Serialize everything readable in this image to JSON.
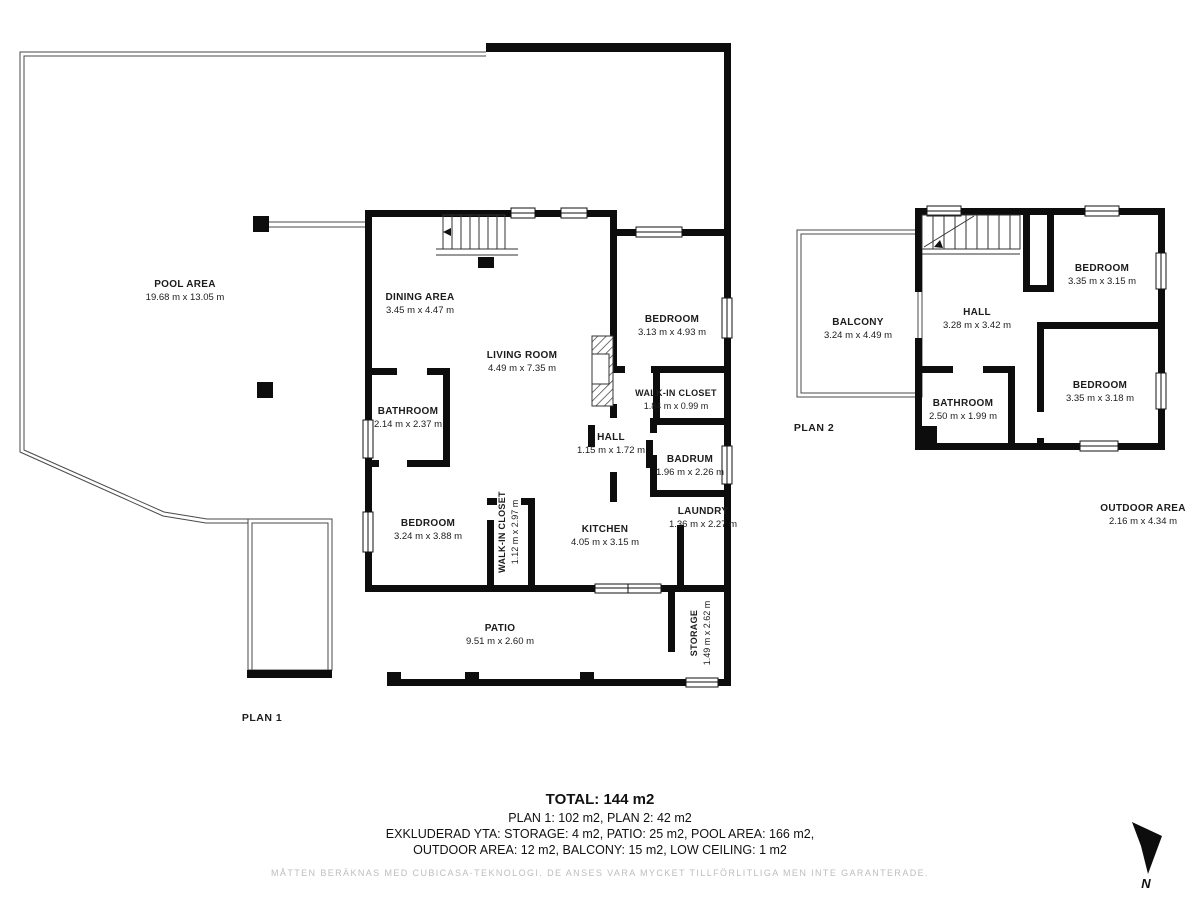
{
  "plan1": {
    "label": "PLAN 1",
    "rooms": {
      "pool": {
        "name": "POOL AREA",
        "dims": "19.68 m x 13.05 m"
      },
      "dining": {
        "name": "DINING AREA",
        "dims": "3.45 m x 4.47 m"
      },
      "living": {
        "name": "LIVING ROOM",
        "dims": "4.49 m x 7.35 m"
      },
      "bedroom_r": {
        "name": "BEDROOM",
        "dims": "3.13 m x 4.93 m"
      },
      "walkin_r": {
        "name": "WALK-IN CLOSET",
        "dims": "1.84 m x 0.99 m"
      },
      "bathroom": {
        "name": "BATHROOM",
        "dims": "2.14 m x 2.37 m"
      },
      "hall": {
        "name": "HALL",
        "dims": "1.15 m x 1.72 m"
      },
      "badrum": {
        "name": "BADRUM",
        "dims": "1.96 m x 2.26 m"
      },
      "laundry": {
        "name": "LAUNDRY",
        "dims": "1.36 m x 2.27 m"
      },
      "bedroom_l": {
        "name": "BEDROOM",
        "dims": "3.24 m x 3.88 m"
      },
      "walkin_l": {
        "name": "WALK-IN CLOSET",
        "dims": "1.12 m x 2.97 m"
      },
      "kitchen": {
        "name": "KITCHEN",
        "dims": "4.05 m x 3.15 m"
      },
      "patio": {
        "name": "PATIO",
        "dims": "9.51 m x 2.60 m"
      },
      "storage": {
        "name": "STORAGE",
        "dims": "1.49 m x 2.62 m"
      }
    }
  },
  "plan2": {
    "label": "PLAN 2",
    "rooms": {
      "balcony": {
        "name": "BALCONY",
        "dims": "3.24 m x 4.49 m"
      },
      "hall": {
        "name": "HALL",
        "dims": "3.28 m x 3.42 m"
      },
      "bedroom_top": {
        "name": "BEDROOM",
        "dims": "3.35 m x 3.15 m"
      },
      "bedroom_bot": {
        "name": "BEDROOM",
        "dims": "3.35 m x 3.18 m"
      },
      "bathroom": {
        "name": "BATHROOM",
        "dims": "2.50 m x 1.99 m"
      },
      "outdoor": {
        "name": "OUTDOOR AREA",
        "dims": "2.16 m x 4.34 m"
      }
    }
  },
  "summary": {
    "total": "TOTAL: 144 m2",
    "plans": "PLAN 1: 102 m2, PLAN 2: 42 m2",
    "excluded1": "EXKLUDERAD YTA: STORAGE: 4 m2, PATIO: 25 m2, POOL AREA: 166 m2,",
    "excluded2": "OUTDOOR AREA: 12 m2, BALCONY: 15 m2, LOW CEILING: 1 m2",
    "disclaimer": "MÅTTEN BERÄKNAS MED CUBICASA-TEKNOLOGI. DE ANSES VARA MYCKET TILLFÖRLITLIGA MEN INTE GARANTERADE."
  },
  "compass": {
    "label": "N"
  },
  "colors": {
    "wall": "#0d0d0d",
    "thin_line": "#4a4a4a",
    "text": "#1c1c1c",
    "disclaimer": "#bdbdbd"
  }
}
